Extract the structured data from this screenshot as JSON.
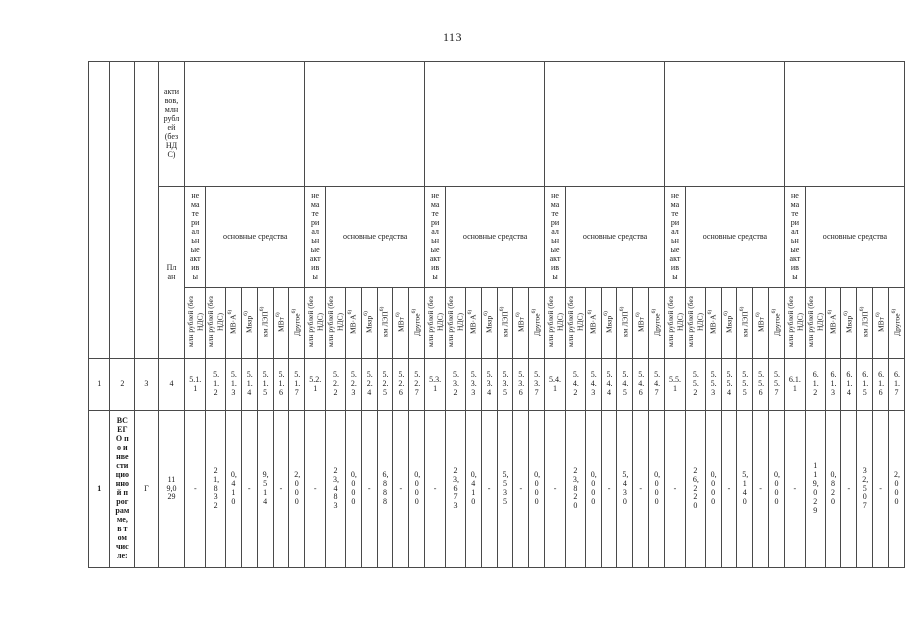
{
  "page_number": "113",
  "table": {
    "header": {
      "col4_top": "активов, млн рублей (без НДС)",
      "plan_label": "План",
      "intangible_label": "нематериальные активы",
      "fixed_assets_label": "основные средства",
      "unit_labels": [
        {
          "text": "млн рублей (без НДС)",
          "sup": "",
          "name": "unit-mln-rub-intangible"
        },
        {
          "text": "млн рублей (без НДС)",
          "sup": "",
          "name": "unit-mln-rub-fixed"
        },
        {
          "text": "МВ·А",
          "sup": "6)",
          "name": "unit-mva"
        },
        {
          "text": "Мвар",
          "sup": "6)",
          "name": "unit-mvar"
        },
        {
          "text": "км ЛЭП",
          "sup": "6)",
          "name": "unit-km-lep"
        },
        {
          "text": "МВт",
          "sup": "6)",
          "name": "unit-mw"
        },
        {
          "text": "Другое",
          "sup": "6)",
          "name": "unit-other"
        }
      ]
    },
    "column_numbers": {
      "left": [
        "1",
        "2",
        "3",
        "4"
      ],
      "groups": [
        [
          "5.1.1",
          "5.1.2",
          "5.1.3",
          "5.1.4",
          "5.1.5",
          "5.1.6",
          "5.1.7"
        ],
        [
          "5.2.1",
          "5.2.2",
          "5.2.3",
          "5.2.4",
          "5.2.5",
          "5.2.6",
          "5.2.7"
        ],
        [
          "5.3.1",
          "5.3.2",
          "5.3.3",
          "5.3.4",
          "5.3.5",
          "5.3.6",
          "5.3.7"
        ],
        [
          "5.4.1",
          "5.4.2",
          "5.4.3",
          "5.4.4",
          "5.4.5",
          "5.4.6",
          "5.4.7"
        ],
        [
          "5.5.1",
          "5.5.2",
          "5.5.3",
          "5.5.4",
          "5.5.5",
          "5.5.6",
          "5.5.7"
        ],
        [
          "6.1.1",
          "6.1.2",
          "6.1.3",
          "6.1.4",
          "6.1.5",
          "6.1.6",
          "6.1.7"
        ]
      ]
    },
    "rows": [
      {
        "num": "1",
        "name": "ВСЕГО по инвестиционной программе, в том числе:",
        "plan_mark": "Г",
        "plan_total": "119,029",
        "groups": [
          [
            "-",
            "21,832",
            "0,410",
            "-",
            "9,514",
            "-",
            "2,000"
          ],
          [
            "-",
            "23,483",
            "0,000",
            "-",
            "6,888",
            "-",
            "0,000"
          ],
          [
            "-",
            "23,673",
            "0,410",
            "-",
            "5,535",
            "-",
            "0,000"
          ],
          [
            "-",
            "23,820",
            "0,000",
            "-",
            "5,430",
            "-",
            "0,000"
          ],
          [
            "-",
            "26,220",
            "0,000",
            "-",
            "5,140",
            "-",
            "0,000"
          ],
          [
            "-",
            "119,029",
            "0,820",
            "-",
            "32,507",
            "-",
            "2,000"
          ]
        ]
      }
    ]
  }
}
